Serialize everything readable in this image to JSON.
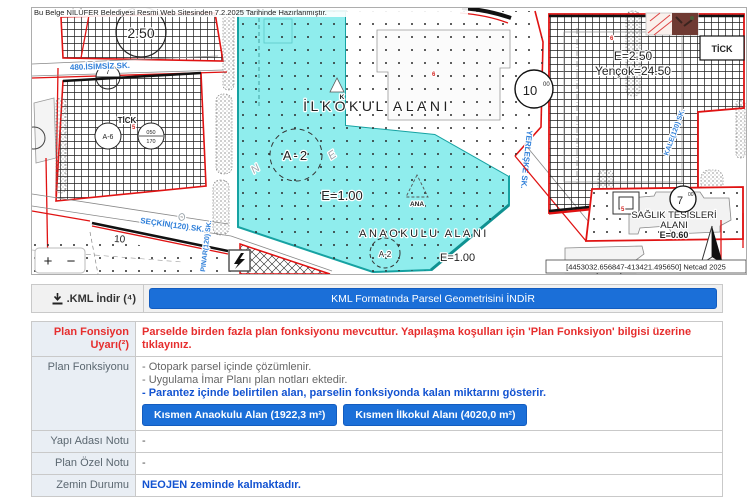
{
  "doc_header": "Bu Belge NİLÜFER Belediyesi Resmi Web Sitesinden 7.2.2025 Tarihinde Hazırlanmıştır.",
  "map": {
    "labels": {
      "ilkokul": "İLKOKUL ALANI",
      "ilkokul_zone": "A-2",
      "ilkokul_e": "E=1.00",
      "ana": "ANA",
      "anaokulu": "ANAOKULU ALANI",
      "anaokulu_zone": "A-2",
      "anaokulu_e": "E=1.00",
      "saglik_line1": "SAĞLIK TESİSLERİ",
      "saglik_line2": "ALANI",
      "saglik_e": "E=0.60",
      "right_e": "E=2.50",
      "right_yencok": "Yençok=24.50",
      "tick_left": "TİCK",
      "tick_right": "TİCK",
      "circle_250": "2.50",
      "circle_a6": "A-6",
      "frac_top": "050",
      "frac_bottom": "170",
      "road_10": "10",
      "road_10_sup": "00",
      "road_7": "7",
      "road_7_sup": "00",
      "small_7": "7",
      "parcel_10": "10",
      "marker_k": "K",
      "letter_n": "N",
      "letter_e": "E",
      "red_6a": "6",
      "red_6b": "6",
      "red_5a": "5",
      "red_5b": "5",
      "red_3": "3",
      "north": "N"
    },
    "streets": {
      "isimsiz": "480.İSİMSİZ SK.",
      "seckin": "SEÇKİN(120) SK.",
      "pinar": "PINAR(120) SK.",
      "yerleske": "YERLEŞKE SK.",
      "kale": "KALE(120) SK."
    },
    "coordinates": "[4453032.656847-413421.495650] Netcad 2025",
    "controls": {
      "zoom_in": "+",
      "zoom_out": "−"
    }
  },
  "kml": {
    "label": ".KML İndir (⁴)",
    "button": "KML Formatında Parsel Geometrisini İNDİR"
  },
  "table": {
    "warning_label": "Plan Fonsiyon Uyarı(²)",
    "warning_text": "Parselde birden fazla plan fonksiyonu mevcuttur. Yapılaşma koşulları için 'Plan Fonksiyon' bilgisi üzerine tıklayınız.",
    "plan_fonksiyonu_label": "Plan Fonksiyonu",
    "plan_notes": [
      "- Otopark parsel içinde çözümlenir.",
      "- Uygulama İmar Planı plan notları ektedir."
    ],
    "plan_note_highlight": "- Parantez içinde belirtilen alan, parselin fonksiyonda kalan miktarını gösterir.",
    "plan_buttons": [
      "Kısmen Anaokulu Alan (1922,3 m²)",
      "Kısmen İlkokul Alanı (4020,0 m²)"
    ],
    "yapi_adasi_label": "Yapı Adası Notu",
    "yapi_adasi_value": "-",
    "plan_ozel_label": "Plan Özel Notu",
    "plan_ozel_value": "-",
    "zemin_label": "Zemin Durumu",
    "zemin_value": "NEOJEN zeminde kalmaktadır."
  },
  "colors": {
    "accent_blue": "#1b6fd8",
    "warning_red": "#e62e2e",
    "note_blue": "#1353d1",
    "street_blue": "#2f7fd9",
    "parcel_cyan": "#8feded",
    "parcel_cyan_border": "#16a2a2",
    "boundary_red": "#e01212"
  }
}
